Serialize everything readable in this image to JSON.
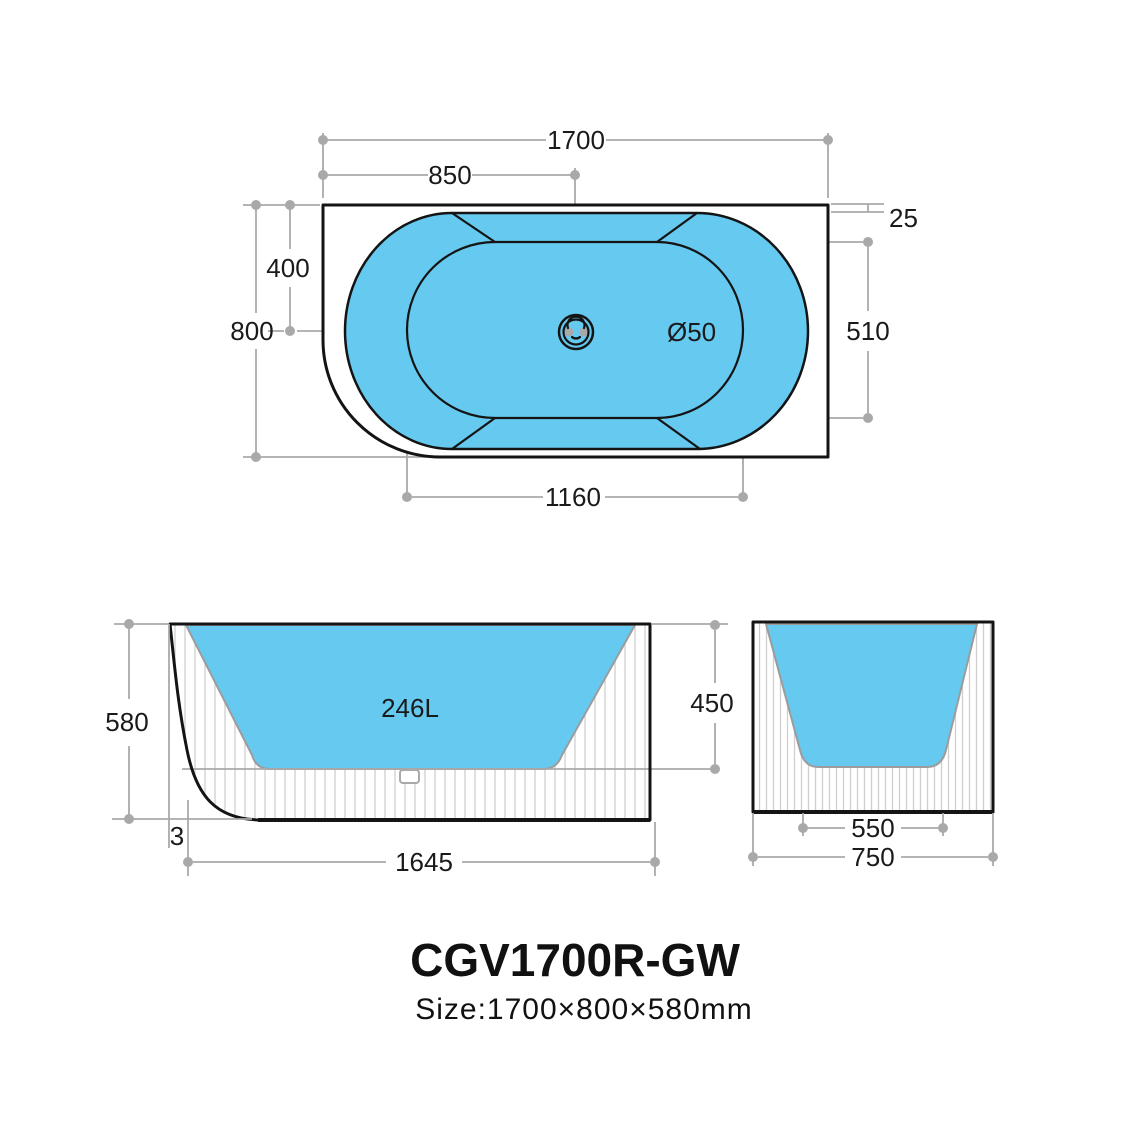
{
  "title": {
    "model": "CGV1700R-GW",
    "size": "Size:1700×800×580mm"
  },
  "colors": {
    "water": "#66C9F0",
    "line": "#141414",
    "dim": "#a9a9a9",
    "hatch": "#cfcfcf"
  },
  "top_view": {
    "length": "1700",
    "half_length": "850",
    "rim_offset": "25",
    "half_width": "400",
    "width": "800",
    "inner_width": "510",
    "inner_floor_length": "1160",
    "drain_diameter": "Ø50"
  },
  "front_view": {
    "height": "580",
    "base_offset": "3",
    "base_length": "1645",
    "depth": "450",
    "capacity": "246L"
  },
  "side_view": {
    "floor_width": "550",
    "width": "750"
  }
}
